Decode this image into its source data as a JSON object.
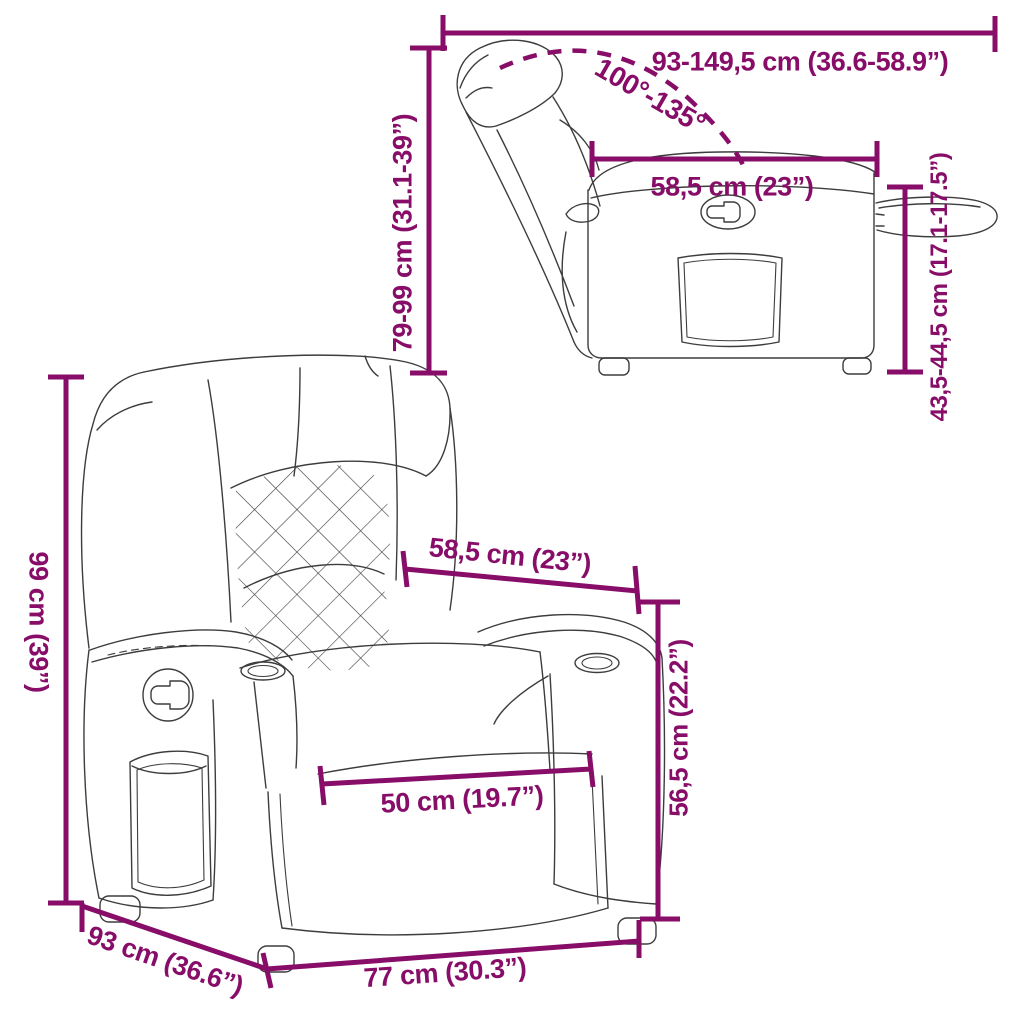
{
  "colors": {
    "dimension_accent": "#870d68",
    "line_art": "#3d3d3d",
    "background": "#ffffff"
  },
  "side_view": {
    "extended_length": "93-149,5 cm (36.6-58.9”)",
    "recline_angle": "100°-135°",
    "seat_depth": "58,5 cm (23”)",
    "back_height": "79-99 cm (31.1-39”)",
    "arm_height": "43,5-44,5 cm (17.1-17.5”)"
  },
  "front_view": {
    "total_height": "99 cm (39”)",
    "seat_width_top": "58,5 cm (23”)",
    "seat_height": "56,5 cm (22.2”)",
    "seat_depth_inner": "50 cm (19.7”)",
    "depth": "93 cm (36.6”)",
    "width": "77 cm (30.3”)"
  }
}
